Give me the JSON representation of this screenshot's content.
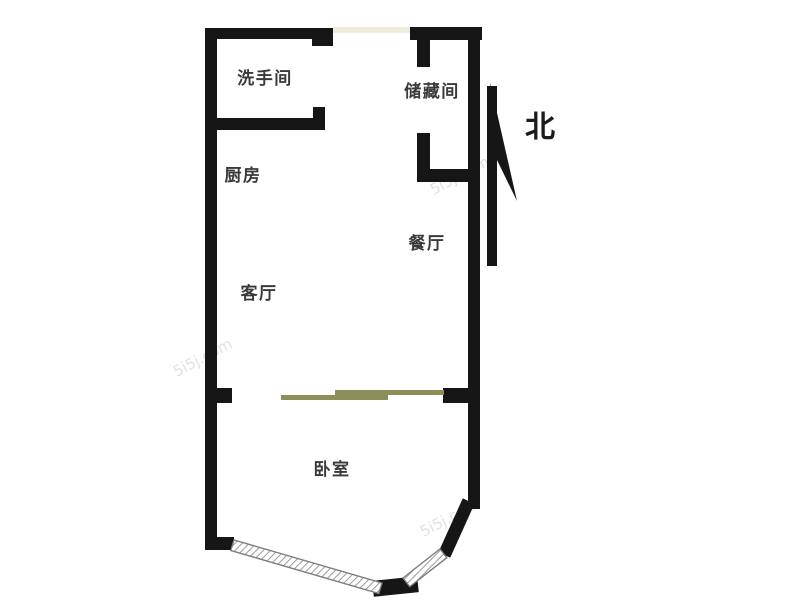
{
  "compass": {
    "label": "北"
  },
  "rooms": [
    {
      "id": "washroom",
      "label": "洗手间"
    },
    {
      "id": "storage",
      "label": "储藏间"
    },
    {
      "id": "kitchen",
      "label": "厨房"
    },
    {
      "id": "dining",
      "label": "餐厅"
    },
    {
      "id": "living",
      "label": "客厅"
    },
    {
      "id": "bedroom",
      "label": "卧室"
    }
  ],
  "watermark": {
    "text": "5i5j.com"
  },
  "colors": {
    "wall": "#161616",
    "label_text": "#3a3a3a",
    "door_panel": "#8e8e5a",
    "entry_opening": "#efeddc",
    "window_outline": "#7d7d7d",
    "background": "#ffffff"
  }
}
